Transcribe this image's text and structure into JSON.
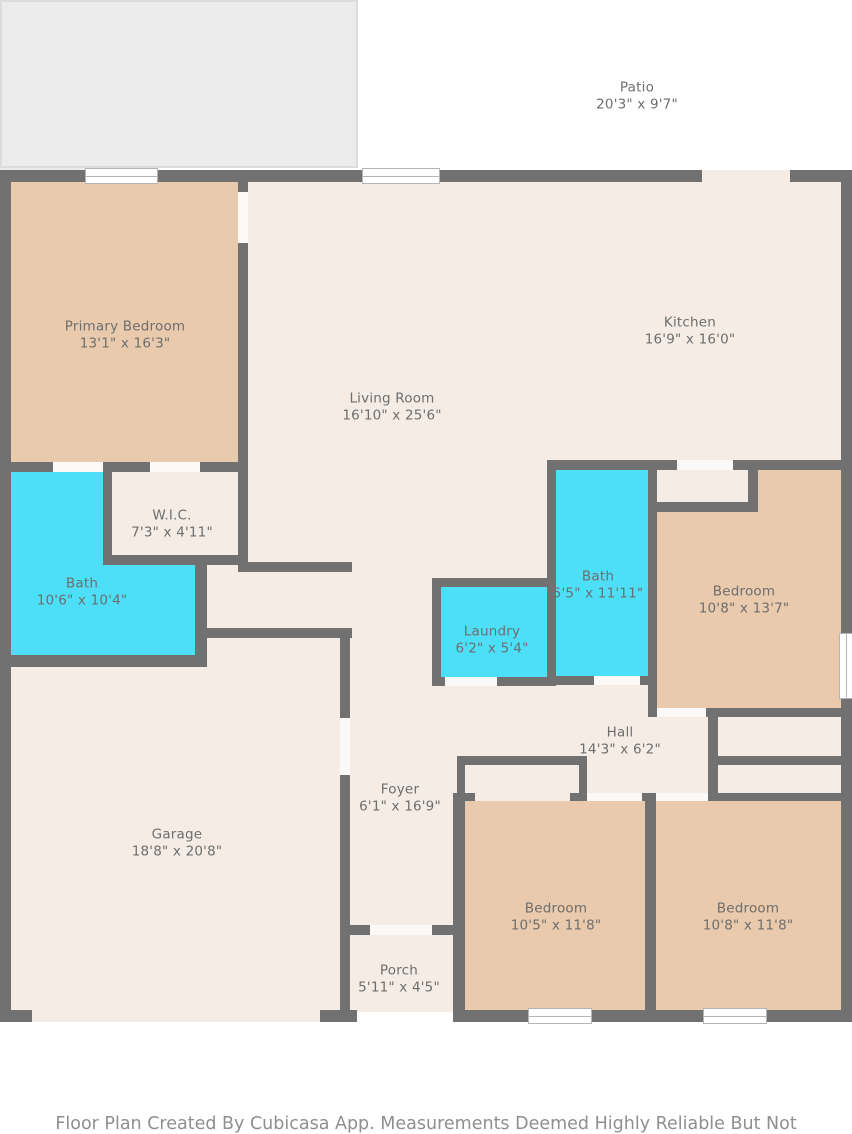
{
  "title": "Floor Plan",
  "colors": {
    "floor": "#f4ece5",
    "tan": "#e9caac",
    "cyan": "#4cdff7",
    "outdoor": "#ececec",
    "outdoor_border": "#dcdcdc",
    "wall": "#717171",
    "door": "#fbfaf8",
    "window_frame": "#b5b5b5",
    "label": "#6e6e6e",
    "footer_text": "#8f8f8f"
  },
  "rooms": [
    {
      "id": "patio",
      "name": "Patio",
      "dims": "20'3\" x 9'7\""
    },
    {
      "id": "primary-bedroom",
      "name": "Primary Bedroom",
      "dims": "13'1\" x 16'3\""
    },
    {
      "id": "kitchen",
      "name": "Kitchen",
      "dims": "16'9\" x 16'0\""
    },
    {
      "id": "living-room",
      "name": "Living Room",
      "dims": "16'10\" x 25'6\""
    },
    {
      "id": "wic",
      "name": "W.I.C.",
      "dims": "7'3\" x 4'11\""
    },
    {
      "id": "bath-primary",
      "name": "Bath",
      "dims": "10'6\" x 10'4\""
    },
    {
      "id": "bath-hall",
      "name": "Bath",
      "dims": "5'5\" x 11'11\""
    },
    {
      "id": "laundry",
      "name": "Laundry",
      "dims": "6'2\" x 5'4\""
    },
    {
      "id": "bedroom-ne",
      "name": "Bedroom",
      "dims": "10'8\" x 13'7\""
    },
    {
      "id": "hall",
      "name": "Hall",
      "dims": "14'3\" x 6'2\""
    },
    {
      "id": "foyer",
      "name": "Foyer",
      "dims": "6'1\" x 16'9\""
    },
    {
      "id": "garage",
      "name": "Garage",
      "dims": "18'8\" x 20'8\""
    },
    {
      "id": "bedroom-s1",
      "name": "Bedroom",
      "dims": "10'5\" x 11'8\""
    },
    {
      "id": "bedroom-s2",
      "name": "Bedroom",
      "dims": "10'8\" x 11'8\""
    },
    {
      "id": "porch",
      "name": "Porch",
      "dims": "5'11\" x 4'5\""
    }
  ],
  "footer": {
    "text": "Floor Plan Created By Cubicasa App. Measurements Deemed Highly Reliable But Not Guaranteed."
  }
}
